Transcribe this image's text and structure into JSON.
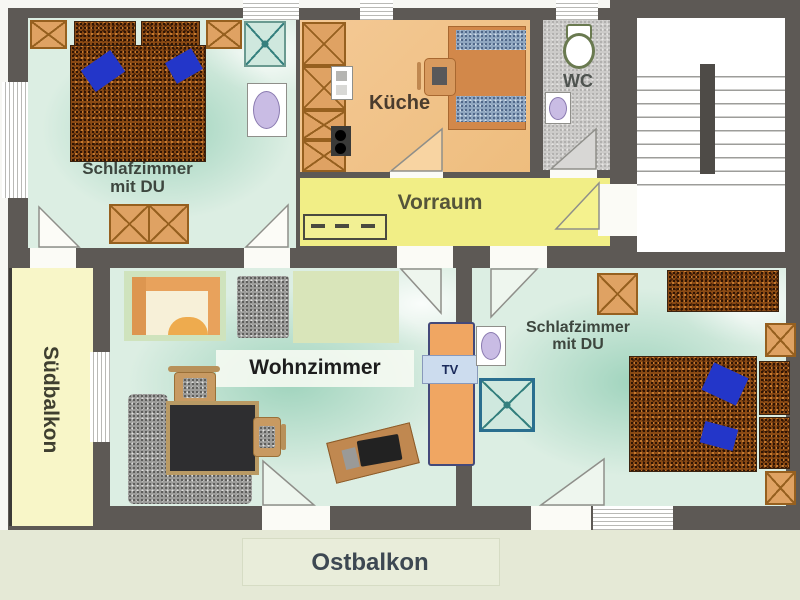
{
  "rooms": {
    "bedroom_left": {
      "name_line1": "Schlafzimmer",
      "name_line2": "mit DU"
    },
    "bedroom_right": {
      "name_line1": "Schlafzimmer",
      "name_line2": "mit DU"
    },
    "kitchen": {
      "name": "Küche"
    },
    "wc": {
      "name": "WC"
    },
    "hallway": {
      "name": "Vorraum"
    },
    "living_room": {
      "name": "Wohnzimmer"
    },
    "south_balcony": {
      "name": "Südbalkon"
    },
    "east_balcony": {
      "name": "Ostbalkon"
    },
    "tv_unit": {
      "label": "TV"
    }
  },
  "colors": {
    "wall": "#5d5955",
    "bedroom_floor": "#dceee3",
    "kitchen_floor": "#f2c48e",
    "hallway_floor": "#f1ee86",
    "south_balcony_floor": "#f8f6c8",
    "east_balcony_floor": "#e5e9d6",
    "wc_floor": "#cccbc9",
    "furniture_orange": "#dfa263",
    "bed_brown": "#8a4a14",
    "pillow_blue": "#2336c9",
    "shower_teal": "#35807e",
    "tv_label_bg": "#ccdcee"
  }
}
